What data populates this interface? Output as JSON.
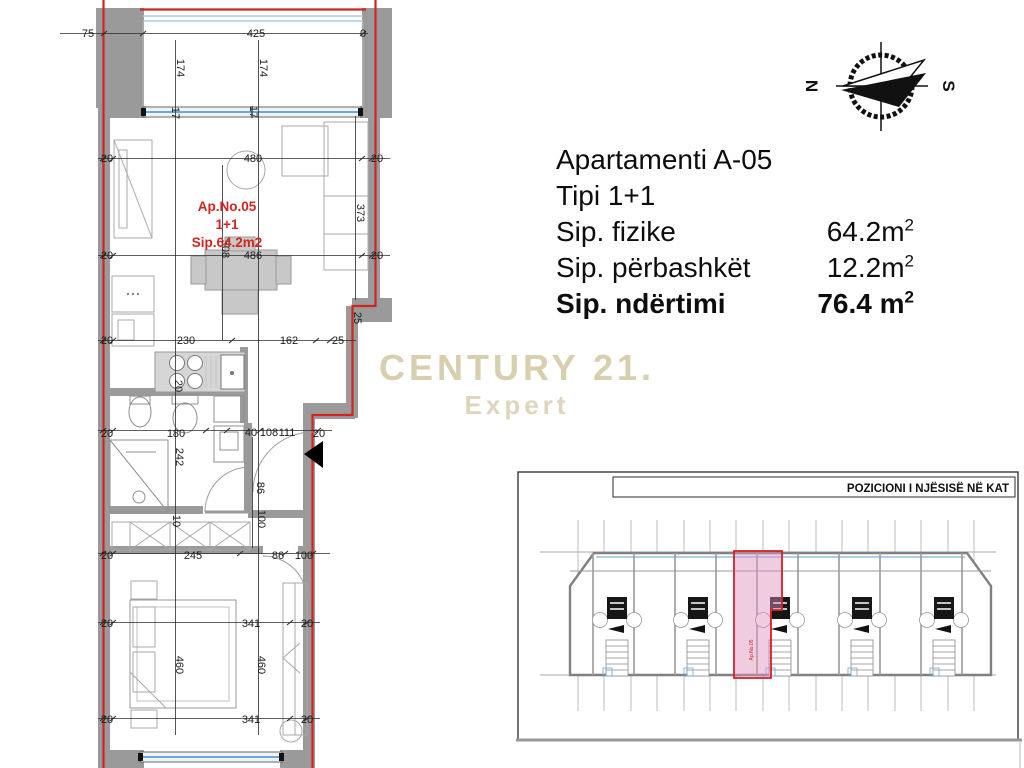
{
  "info": {
    "title": "Apartamenti A-05",
    "type": "Tipi 1+1",
    "rows": [
      {
        "label": "Sip. fizike",
        "value": "64.2m",
        "sup": "2"
      },
      {
        "label": "Sip. përbashkët",
        "value": "12.2m",
        "sup": "2"
      },
      {
        "label": "Sip. ndërtimi",
        "value": "76.4 m",
        "sup": "2"
      }
    ]
  },
  "watermark": {
    "line1": "CENTURY 21.",
    "line2": "Expert"
  },
  "compass": {
    "north": "N",
    "south": "S"
  },
  "plan": {
    "unit_label": {
      "line1": "Ap.No.05",
      "line2": "1+1",
      "line3": "Sip.64.2m2"
    },
    "dims": [
      "75",
      "425",
      "0",
      "174",
      "174",
      "17",
      "17",
      "20",
      "480",
      "20",
      "373",
      "508",
      "20",
      "486",
      "20",
      "25",
      "20",
      "230",
      "162",
      "25",
      "20",
      "20",
      "180",
      "40",
      "108",
      "111",
      "20",
      "242",
      "86",
      "100",
      "10",
      "20",
      "245",
      "86",
      "100",
      "20",
      "341",
      "20",
      "460",
      "460",
      "20",
      "341",
      "20"
    ]
  },
  "keyplan": {
    "title": "POZICIONI I NJËSISË NË KAT",
    "unit_label": "Ap.No.05"
  },
  "colors": {
    "unit_boundary_red": "#d2251f",
    "wall_gray": "#9a9a9a",
    "window_blue": "#7fb3dc",
    "highlight_pink": "#dd8ebc",
    "watermark_beige": "#d8cfae"
  }
}
